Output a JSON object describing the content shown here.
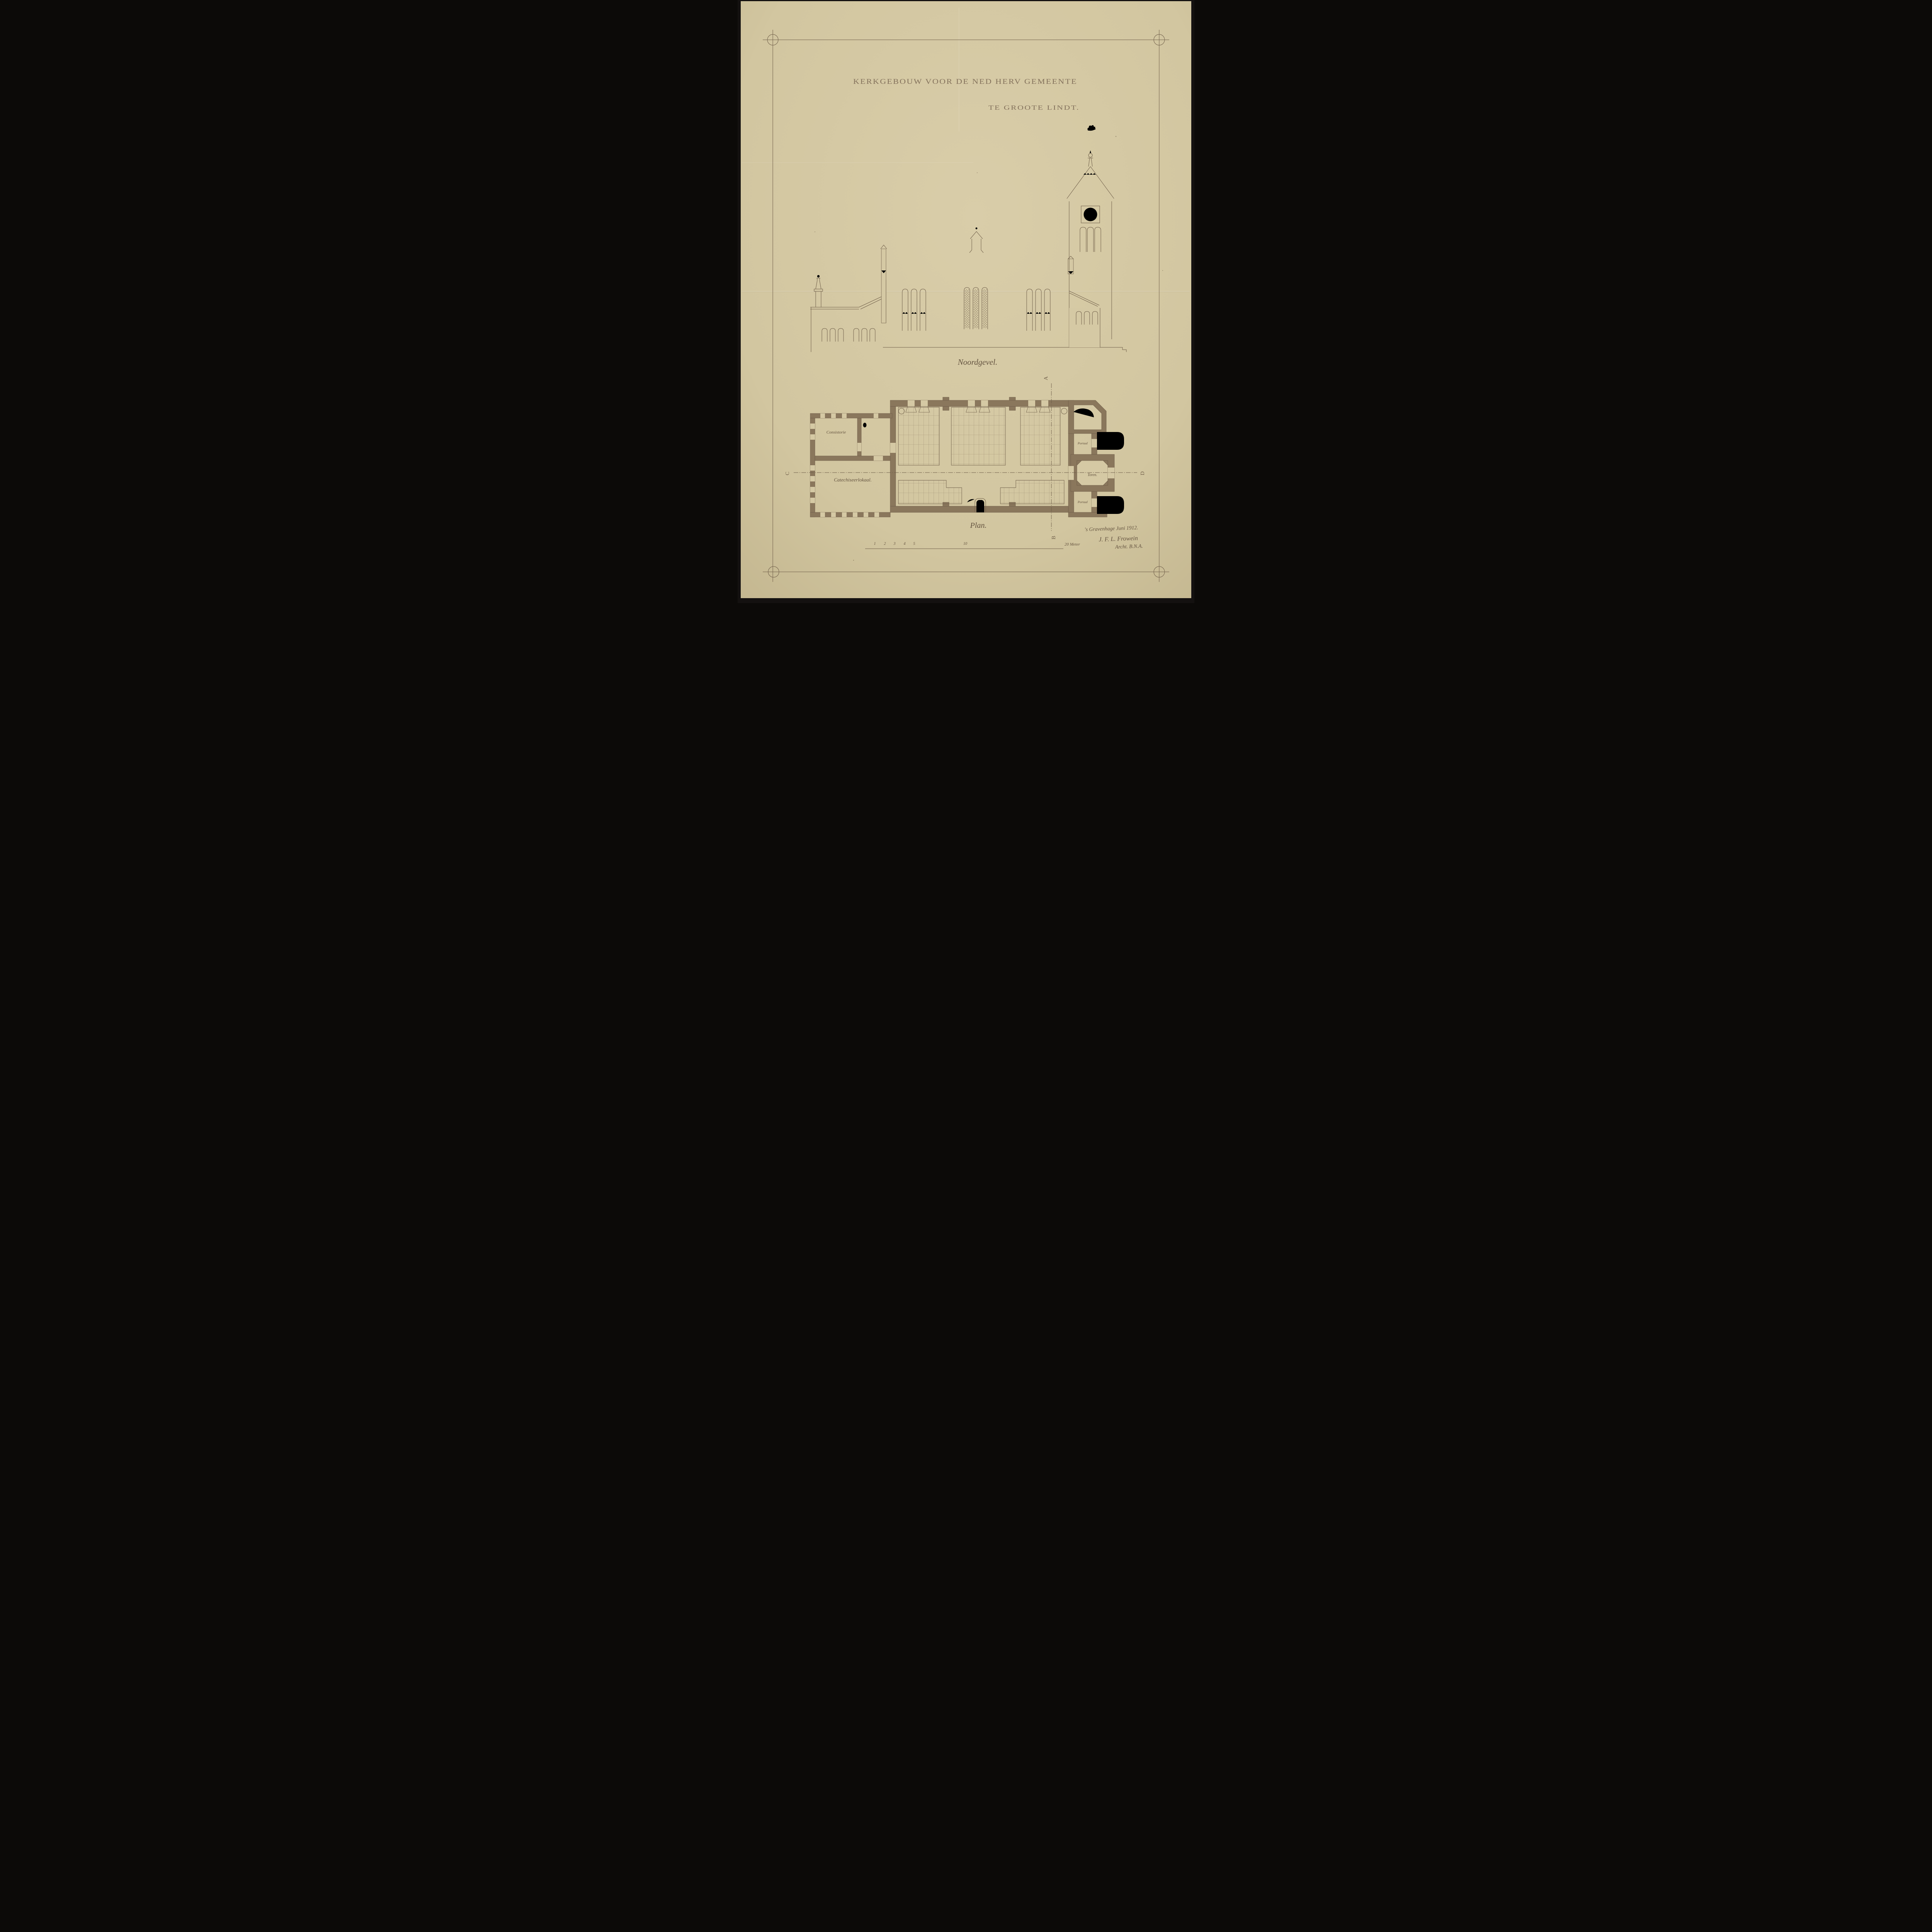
{
  "sheet": {
    "title_line1": "KERKGEBOUW VOOR DE NED HERV GEMEENTE",
    "title_line2": "TE GROOTE LINDT.",
    "elevation_caption": "Noordgevel.",
    "plan_caption": "Plan.",
    "rooms": {
      "consistorie": "Consistorie",
      "catechiseerlokaal": "Catechiseerlokaal.",
      "portaal_north": "Portaal",
      "toren": "Toren.",
      "portaal_south": "Portaal"
    },
    "section_markers": {
      "a": "A",
      "b": "B",
      "c": "C",
      "d": "D"
    },
    "scale_bar": {
      "ticks": [
        "1",
        "2",
        "3",
        "4",
        "5",
        "10"
      ],
      "end_label": "20 Meter"
    },
    "signature": {
      "place_date": "'s Gravenhage Juni 1912.",
      "architect": "J. F. L. Frowein",
      "credential": "Archt. B.N.A."
    },
    "tower_clock": {
      "numeral_style": "roman I-XII",
      "hands_shown": true
    },
    "weathervane": "rooster"
  },
  "colors": {
    "backdrop": "#141110",
    "paper": "#d5c9a4",
    "paper_edge": "#c3b68f",
    "ink": "#6e5d48",
    "wall_fill": "#8a775c",
    "handwriting": "#63523f",
    "title_ink": "#84725c"
  }
}
